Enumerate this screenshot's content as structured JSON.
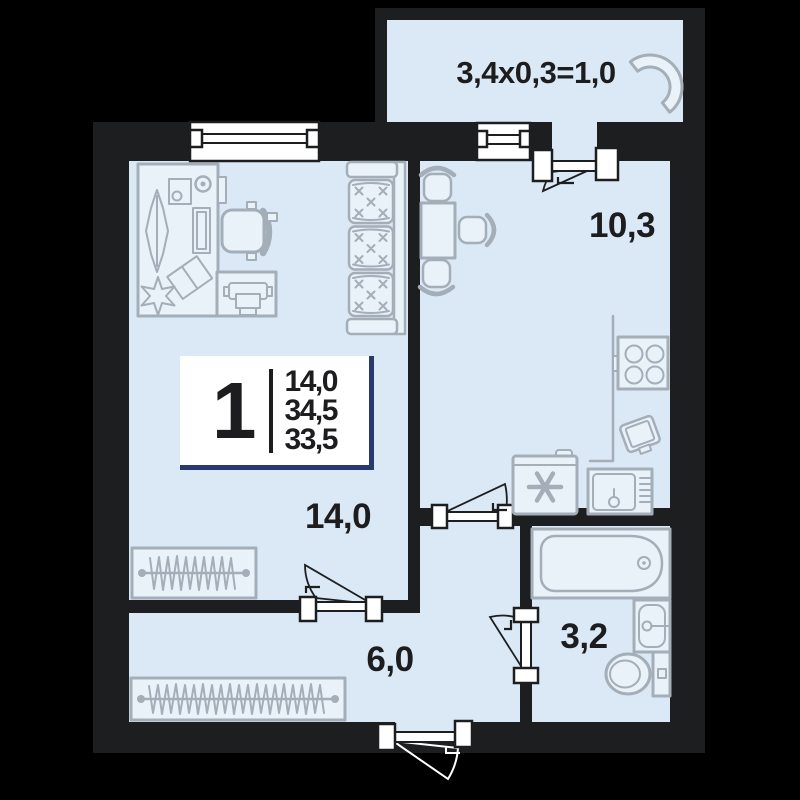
{
  "floorplan": {
    "badge": {
      "rooms_count": "1",
      "areas": [
        "14,0",
        "34,5",
        "33,5"
      ]
    },
    "labels": {
      "living_room": "14,0",
      "kitchen": "10,3",
      "hallway": "6,0",
      "bathroom": "3,2",
      "balcony": "3,4x0,3=1,0"
    },
    "colors": {
      "background": "#000000",
      "wall": "#1d1e20",
      "floor": "#dbe9f6",
      "furniture_outline": "#a4aeb8",
      "badge_accent": "#273970",
      "text": "#1d1d1f"
    }
  }
}
